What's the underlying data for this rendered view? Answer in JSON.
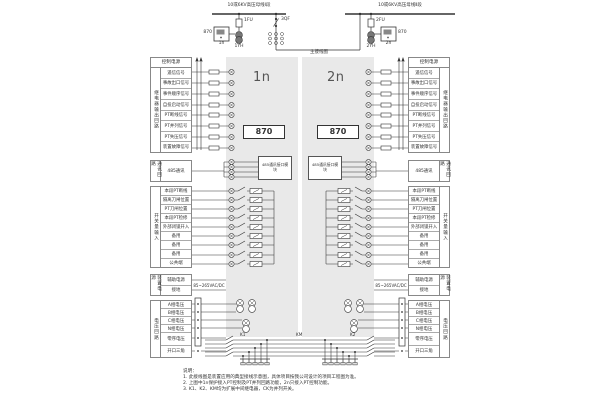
{
  "top": {
    "bus1_label": "10或6KV高压母线Ⅰ段",
    "bus2_label": "10或6KV高压母线Ⅱ段",
    "fuse1": "1FU",
    "fuse2": "2FU",
    "pt1": "1YH",
    "pt2": "2YH",
    "breaker": "3QF",
    "main_wiring": "主接线图",
    "device_model": "870",
    "unit1": "1n",
    "unit2": "2n"
  },
  "device": {
    "model": "870",
    "unit_left": "1n",
    "unit_right": "2n",
    "comm_module": "485通讯接口模块"
  },
  "tables": {
    "control": {
      "header": "控制电源",
      "vertical": "继电器输出回路",
      "rows": [
        "遥信信号",
        "事故出口信号",
        "事件顺序信号",
        "自投启动信号",
        "PT断线信号",
        "PT并列信号",
        "PT失压信号",
        "装置故障信号"
      ]
    },
    "comm": {
      "vertical": "通讯回路",
      "rows": [
        "485通讯"
      ]
    },
    "binary": {
      "vertical": "开关量输入",
      "rows": [
        "本段PT断线",
        "隔离刀闸位置",
        "PT刀闸位置",
        "本段PT检修",
        "外部闭锁开入",
        "备用",
        "备用",
        "备用",
        "公共端"
      ]
    },
    "power": {
      "vertical": "装置电源",
      "rows": [
        "辅助电源",
        "接地"
      ],
      "note": "85~265VAC/DC"
    },
    "voltage": {
      "vertical": "电压回路",
      "rows": [
        "A相电压",
        "B相电压",
        "C相电压",
        "N相电压",
        "零序电压",
        "开口三角"
      ]
    }
  },
  "relays": {
    "k1": "K1",
    "km": "KM",
    "k2": "K2"
  },
  "notes": {
    "title": "说明：",
    "items": [
      "1. 此接线图是装置应用的典型接线示意图，具体项目按我公司设计的项目工程图为准。",
      "2. 上图中1n保护接入PT控制及PT并列回路功能，2n只接入PT控制功能。",
      "3. K1、K2、KM均为扩展中间继电器，CK为并列开关。"
    ]
  }
}
